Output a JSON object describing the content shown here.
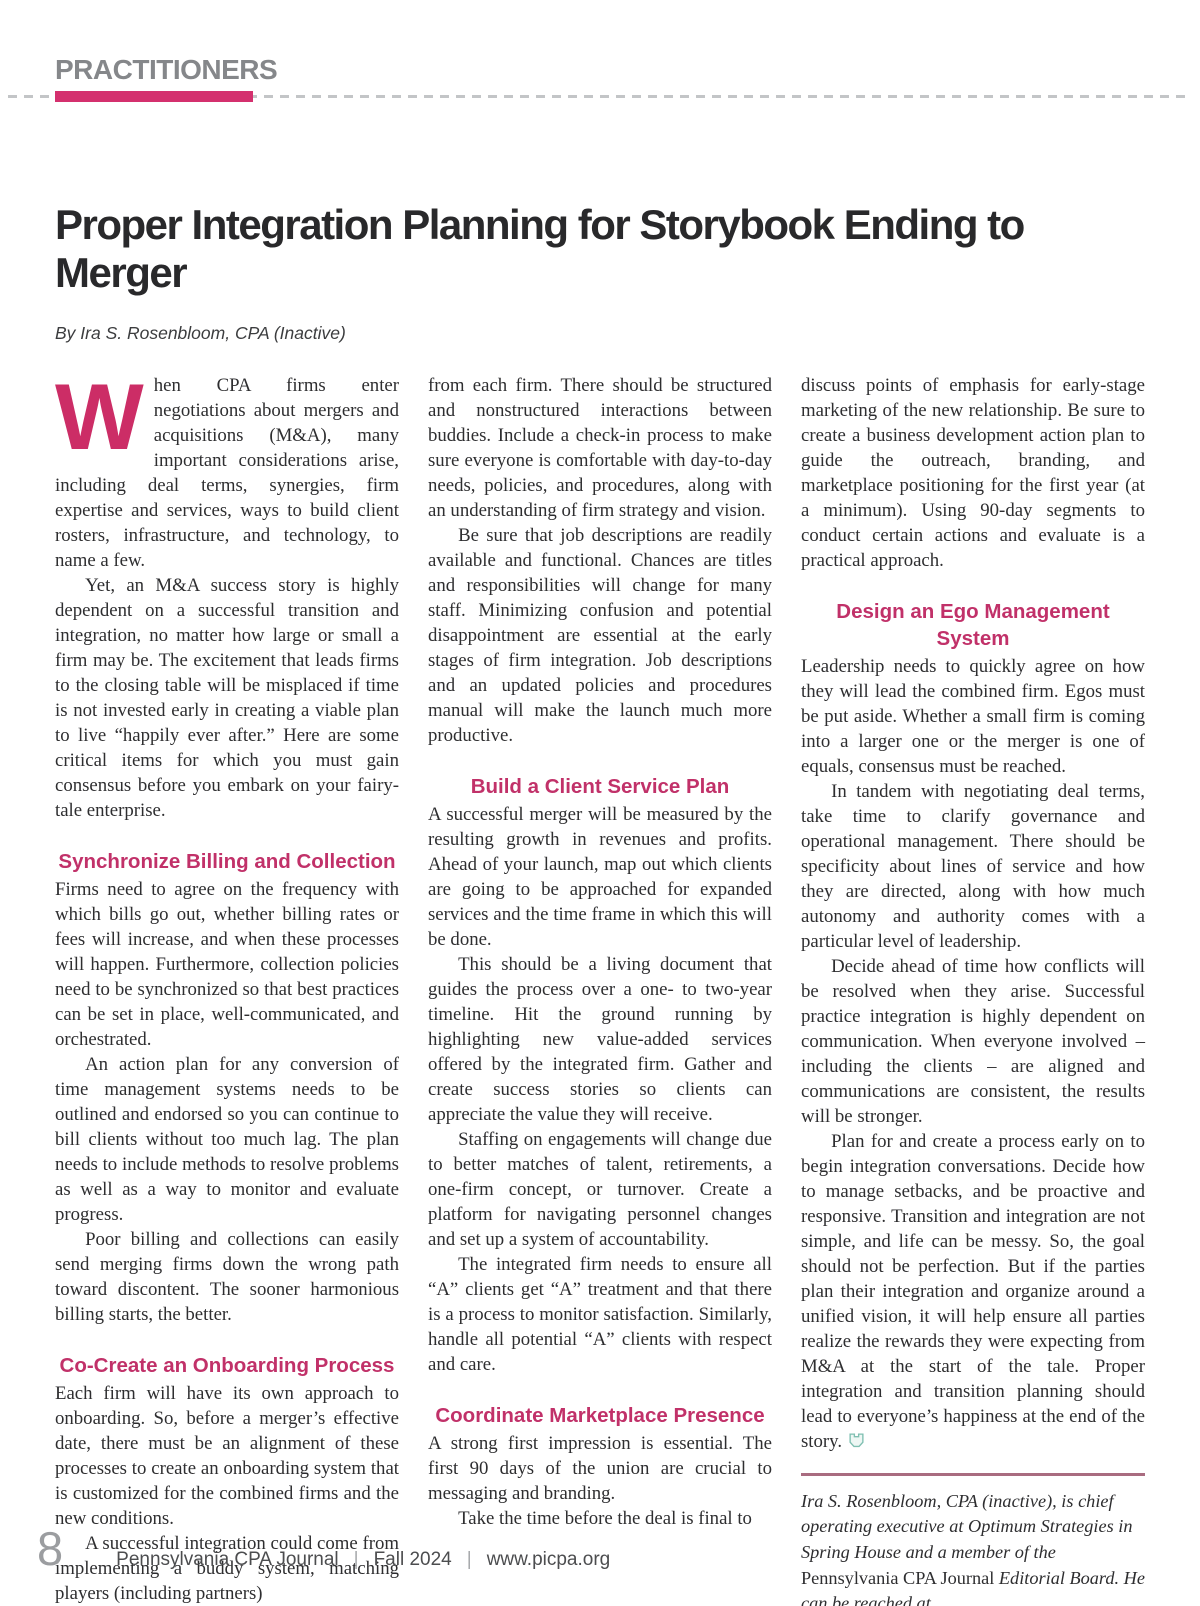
{
  "header": {
    "section_label": "PRACTITIONERS",
    "title": "Proper Integration Planning for Storybook Ending to Merger",
    "byline": "By Ira S. Rosenbloom, CPA (Inactive)"
  },
  "colors": {
    "accent_pink": "#d4306e",
    "heading_pink": "#c13169",
    "dropcap_pink": "#cc2d66",
    "label_gray": "#85878a",
    "bio_rule": "#a96c80",
    "end_icon_teal": "#7fbfb1"
  },
  "columns": {
    "col1": {
      "dropcap": "W",
      "blocks": {
        "b0": {
          "text": "hen CPA firms enter negotiations about mergers and acquisitions (M&A), many important considerations arise, including deal terms, synergies, firm expertise and services, ways to build client rosters, infrastructure, and technology, to name a few."
        },
        "b1": {
          "text": "Yet, an M&A success story is highly dependent on a successful transition and integration, no matter how large or small a firm may be. The excitement that leads firms to the closing table will be misplaced if time is not invested early in creating a viable plan to live “happily ever after.” Here are some critical items for which you must gain consensus before you embark on your fairy-tale enterprise."
        },
        "h1": {
          "text": "Synchronize Billing and Collection"
        },
        "b2": {
          "text": "Firms need to agree on the frequency with which bills go out, whether billing rates or fees will increase, and when these processes will happen. Furthermore, collection policies need to be synchronized so that best practices can be set in place, well-communicated, and orchestrated."
        },
        "b3": {
          "text": "An action plan for any conversion of time management systems needs to be outlined and endorsed so you can continue to bill clients without too much lag. The plan needs to include methods to resolve problems as well as a way to monitor and evaluate progress."
        },
        "b4": {
          "text": "Poor billing and collections can easily send merging firms down the wrong path toward discontent. The sooner harmonious billing starts, the better."
        },
        "h2": {
          "text": "Co-Create an Onboarding Process"
        },
        "b5": {
          "text": "Each firm will have its own approach to onboarding. So, before a merger’s effective date, there must be an alignment of these processes to create an onboarding system that is customized for the combined firms and the new conditions."
        },
        "b6": {
          "text": "A successful integration could come from implementing a buddy system, matching players (including partners)"
        }
      }
    },
    "col2": {
      "blocks": {
        "b0": {
          "text": "from each firm. There should be structured and nonstructured interactions between buddies. Include a check-in process to make sure everyone is comfortable with day-to-day needs, policies, and procedures, along with an understanding of firm strategy and vision."
        },
        "b1": {
          "text": "Be sure that job descriptions are readily available and functional. Chances are titles and responsibilities will change for many staff. Minimizing confusion and potential disappointment are essential at the early stages of firm integration. Job descriptions and an updated policies and procedures manual will make the launch much more productive."
        },
        "h1": {
          "text": "Build a Client Service Plan"
        },
        "b2": {
          "text": "A successful merger will be measured by the resulting growth in revenues and profits. Ahead of your launch, map out which clients are going to be approached for expanded services and the time frame in which this will be done."
        },
        "b3": {
          "text": "This should be a living document that guides the process over a one- to two-year timeline. Hit the ground running by highlighting new value-added services offered by the integrated firm. Gather and create success stories so clients can appreciate the value they will receive."
        },
        "b4": {
          "text": "Staffing on engagements will change due to better matches of talent, retirements, a one-firm concept, or turnover. Create a platform for navigating personnel changes and set up a system of accountability."
        },
        "b5": {
          "text": "The integrated firm needs to ensure all “A” clients get “A” treatment and that there is a process to monitor satisfaction. Similarly, handle all potential “A” clients with respect and care."
        },
        "h2": {
          "text": "Coordinate Marketplace Presence"
        },
        "b6": {
          "text": "A strong first impression is essential. The first 90 days of the union are crucial to messaging and branding."
        },
        "b7": {
          "text": "Take the time before the deal is final to"
        }
      }
    },
    "col3": {
      "blocks": {
        "b0": {
          "text": "discuss points of emphasis for early-stage marketing of the new relationship. Be sure to create a business development action plan to guide the outreach, branding, and marketplace positioning for the first year (at a minimum). Using 90-day segments to conduct certain actions and evaluate is a practical approach."
        },
        "h1": {
          "text": "Design an Ego Management System"
        },
        "b1": {
          "text": "Leadership needs to quickly agree on how they will lead the combined firm. Egos must be put aside. Whether a small firm is coming into a larger one or the merger is one of equals, consensus must be reached."
        },
        "b2": {
          "text": "In tandem with negotiating deal terms, take time to clarify governance and operational management. There should be specificity about lines of service and how they are directed, along with how much autonomy and authority comes with a particular level of leadership."
        },
        "b3": {
          "text": "Decide ahead of time how conflicts will be resolved when they arise. Successful practice integration is highly dependent on communication. When everyone involved – including the clients – are aligned and communications are consistent, the results will be stronger."
        },
        "b4": {
          "text": "Plan for and create a process early on to begin integration conversations. Decide how to manage setbacks, and be proactive and responsive. Transition and integration are not simple, and life can be messy. So, the goal should not be perfection. But if the parties plan their integration and organize around a unified vision, it will help ensure all parties realize the rewards they were expecting from M&A at the start of the tale. Proper integration and transition planning should lead to everyone’s happiness at the end of the story."
        }
      }
    }
  },
  "bio": {
    "italic_1": "Ira S. Rosenbloom, CPA (inactive), is chief operating executive at Optimum Strategies in Spring House and a member of the ",
    "roman": "Pennsylvania CPA Journal ",
    "italic_2": "Editorial Board. He can be reached at ira@optimumstrategies.com."
  },
  "footer": {
    "page_number": "8",
    "journal_name": "Pennsylvania CPA Journal",
    "issue": "Fall 2024",
    "url": "www.picpa.org",
    "separator": "|"
  }
}
